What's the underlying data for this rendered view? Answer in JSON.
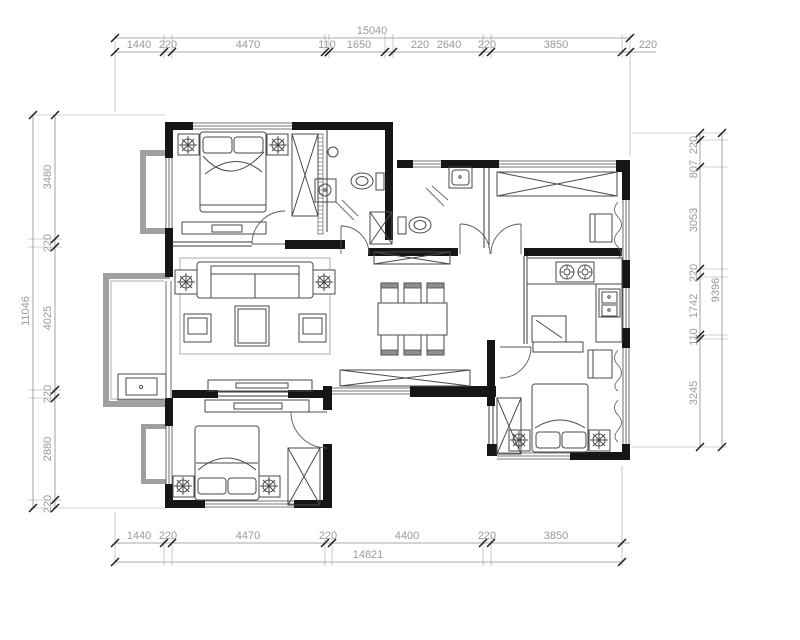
{
  "drawing": {
    "type": "apartment-floor-plan",
    "dims": {
      "top": {
        "total": "15040",
        "segments": [
          "1440",
          "220",
          "4470",
          "110",
          "1650",
          "220",
          "2640",
          "220",
          "3850",
          "220"
        ]
      },
      "bottom": {
        "total": "14821",
        "segments": [
          "1440",
          "220",
          "4470",
          "220",
          "4400",
          "220",
          "3850"
        ]
      },
      "left": {
        "total": "11046",
        "segments": [
          "3480",
          "220",
          "4025",
          "220",
          "2880",
          "220"
        ]
      },
      "right": {
        "total": "9396",
        "segments": [
          "220",
          "807",
          "3053",
          "220",
          "1742",
          "110",
          "3245"
        ]
      }
    },
    "colors": {
      "wall": "#161616",
      "balcony_wall": "#a0a0a0",
      "dimension_text": "#9a9a9a",
      "background": "#ffffff"
    }
  }
}
